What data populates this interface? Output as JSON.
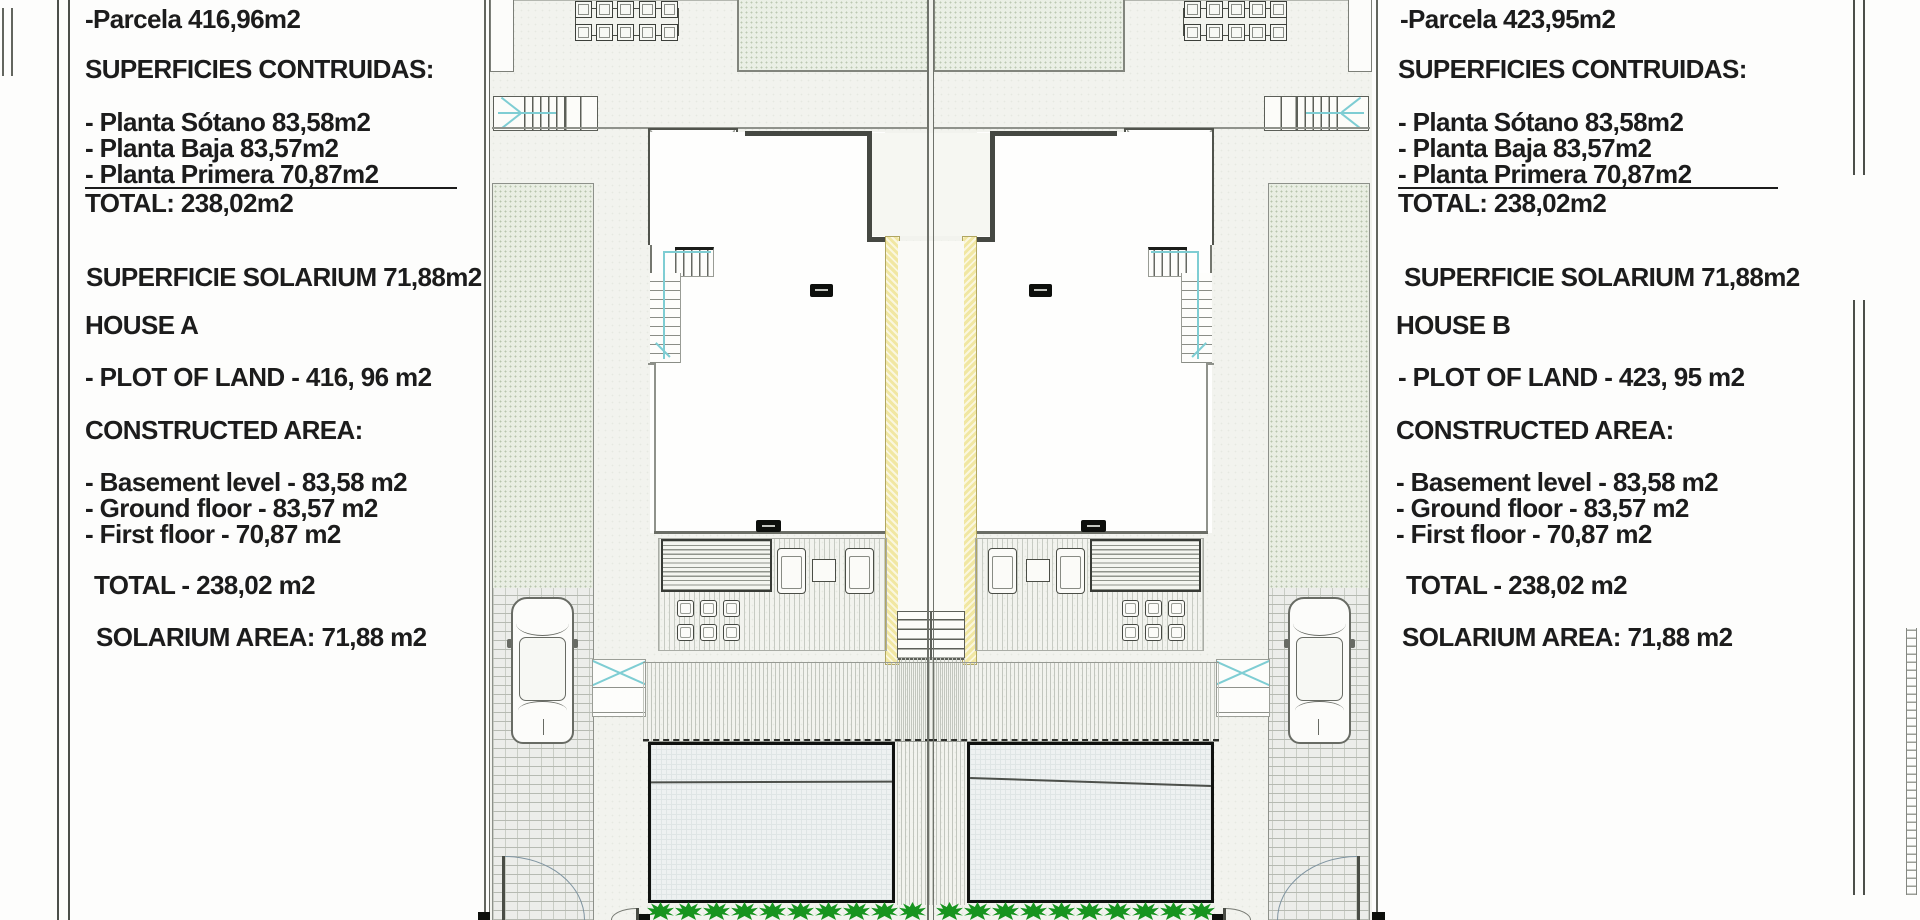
{
  "title": "Semi-detached houses site plan — House A / House B surface schedule",
  "left_panel": {
    "parcela": "-Parcela 416,96m2",
    "superficies_title": "SUPERFICIES CONTRUIDAS:",
    "planta_sotano": "- Planta Sótano 83,58m2",
    "planta_baja": "- Planta Baja 83,57m2",
    "planta_primera": "- Planta Primera 70,87m2",
    "total_es": "TOTAL: 238,02m2",
    "superficie_solarium": "SUPERFICIE SOLARIUM 71,88m2",
    "house_title": "HOUSE A",
    "plot_of_land": "- PLOT OF LAND - 416, 96 m2",
    "constructed_title": "CONSTRUCTED AREA:",
    "basement": "- Basement level - 83,58 m2",
    "ground_floor": "- Ground floor - 83,57 m2",
    "first_floor": "- First floor - 70,87 m2",
    "total_en": "TOTAL - 238,02 m2",
    "solarium_area": "SOLARIUM AREA: 71,88 m2"
  },
  "right_panel": {
    "parcela": "-Parcela 423,95m2",
    "superficies_title": "SUPERFICIES CONTRUIDAS:",
    "planta_sotano": "- Planta Sótano 83,58m2",
    "planta_baja": "- Planta Baja 83,57m2",
    "planta_primera": "- Planta Primera 70,87m2",
    "total_es": "TOTAL: 238,02m2",
    "superficie_solarium": "SUPERFICIE SOLARIUM 71,88m2",
    "house_title": "HOUSE B",
    "plot_of_land": "- PLOT OF LAND - 423, 95 m2",
    "constructed_title": "CONSTRUCTED AREA:",
    "basement": "- Basement level - 83,58 m2",
    "ground_floor": "- Ground floor - 83,57 m2",
    "first_floor": "- First floor - 70,87 m2",
    "total_en": "TOTAL - 238,02 m2",
    "solarium_area": "SOLARIUM AREA: 71,88 m2"
  },
  "colors": {
    "ink": "#1c1c1c",
    "party-yellow": "#f1e7a2",
    "hedge-green": "#17941f",
    "guide-cyan": "#7ecdd3",
    "pool-border": "#101210"
  }
}
